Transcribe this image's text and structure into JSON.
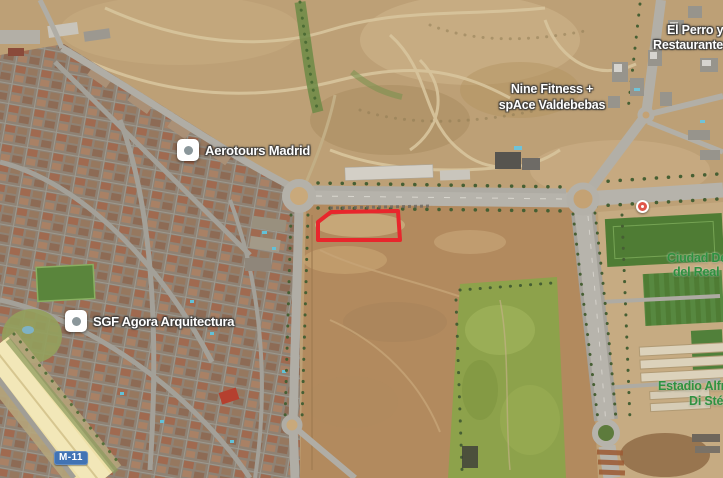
{
  "pois": {
    "aerotours": {
      "label": "Aerotours Madrid"
    },
    "sgf_agora": {
      "label": "SGF Agora Arquitectura"
    },
    "nine_fitness": {
      "line1": "Nine Fitness +",
      "line2": "spAce Valdebebas"
    },
    "el_perro": {
      "line1": "El Perro y",
      "line2": "Restaurante"
    }
  },
  "area_labels": {
    "ciudad_deportiva": {
      "line1": "Ciudad De",
      "line2": "del Real"
    },
    "estadio_di_stefano": {
      "line1": "Estadio Alfr",
      "line2": "Di Stéf"
    }
  },
  "roads": {
    "m11_badge": "M-11"
  },
  "annotation": {
    "shape": "polygon",
    "points": "331,212 398,211 400,240 318,240 318,222",
    "color": "#e8262c",
    "stroke_width": "4"
  },
  "colors": {
    "terrain_tan": "#bda076",
    "dirt_parcel": "#b28a5e",
    "meadow_green": "#8da24b",
    "pitch_green": "#4f7c34",
    "road_grey": "#b4b1a9",
    "highway_yellow": "#eee0a8",
    "badge_blue": "#4173b4",
    "poi_marker_red": "#e0564b",
    "area_label_green": "#2f9140"
  }
}
